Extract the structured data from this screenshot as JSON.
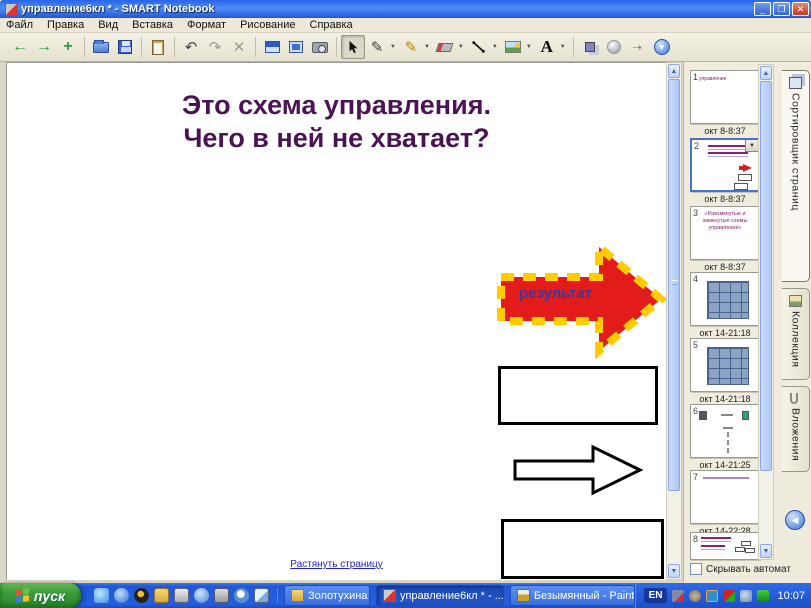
{
  "window": {
    "title": "управление6кл * - SMART Notebook"
  },
  "menu": {
    "items": [
      "Файл",
      "Правка",
      "Вид",
      "Вставка",
      "Формат",
      "Рисование",
      "Справка"
    ]
  },
  "toolbar": {
    "icons": [
      "previous-page",
      "next-page",
      "add-page",
      "open",
      "save",
      "paste",
      "undo",
      "redo",
      "delete",
      "screen-shade",
      "full-screen",
      "capture",
      "select",
      "pen",
      "creative-pen",
      "eraser",
      "line",
      "picture",
      "text",
      "properties",
      "transparency",
      "move-toolbar",
      "dock-toolbar"
    ]
  },
  "canvas": {
    "heading_line1": "Это схема управления.",
    "heading_line2": "Чего в ней не хватает?",
    "arrow_label": "результат",
    "stretch_link": "Растянуть страницу"
  },
  "sidebar": {
    "tabs": [
      {
        "label": "Сортировщик страниц"
      },
      {
        "label": "Коллекция"
      },
      {
        "label": "Вложения"
      }
    ],
    "autohide_label": "Скрывать автомат",
    "pages": [
      {
        "number": "1",
        "note": "управление",
        "caption": "окт 8-8:37"
      },
      {
        "number": "2",
        "caption": "окт 8-8:37"
      },
      {
        "number": "3",
        "note": "«Разомкнутые и замкнутые схемы управления»",
        "caption": "окт 8-8:37"
      },
      {
        "number": "4",
        "caption": "окт 14-21:18"
      },
      {
        "number": "5",
        "caption": "окт 14-21:18"
      },
      {
        "number": "6",
        "caption": "окт 14-21:25"
      },
      {
        "number": "7",
        "caption": "окт 14-22:28"
      },
      {
        "number": "8",
        "caption": ""
      }
    ]
  },
  "taskbar": {
    "start_label": "пуск",
    "buttons": [
      {
        "label": "Золотухина"
      },
      {
        "label": "управление6кл * - ..."
      },
      {
        "label": "Безымянный - Paint"
      }
    ],
    "language": "EN",
    "time": "10:07"
  },
  "colors": {
    "titlebar_blue": "#2A63E8",
    "taskbar_blue": "#245EDC",
    "start_green": "#3B9B3B",
    "heading_purple": "#4B1254",
    "arrow_red": "#E31B1B",
    "arrow_yellow": "#FFCC00",
    "link_blue": "#2222CC"
  }
}
